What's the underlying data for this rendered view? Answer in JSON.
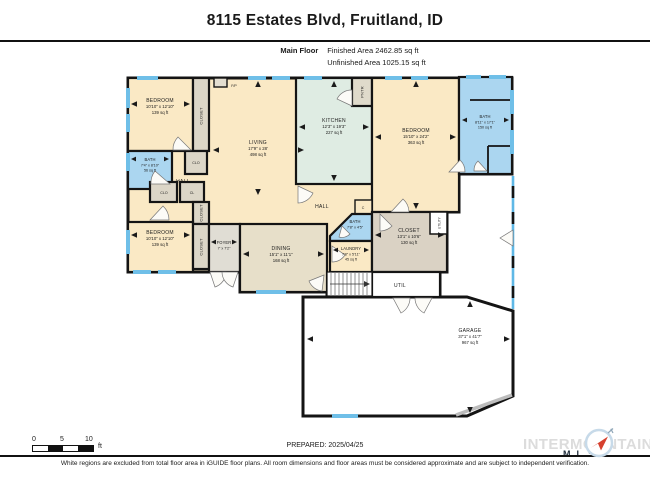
{
  "header": {
    "title": "8115 Estates Blvd, Fruitland, ID",
    "floor_label": "Main Floor",
    "finished_area": "Finished Area 2462.85 sq ft",
    "unfinished_area": "Unfinished Area 1025.15 sq ft"
  },
  "rooms": [
    {
      "name": "BEDROOM",
      "dims": "10'10\" x 12'10\"",
      "area": "139 sq ft"
    },
    {
      "name": "LIVING",
      "dims": "17'9\" x 28'",
      "area": "498 sq ft"
    },
    {
      "name": "KITCHEN",
      "dims": "12'3\" x 19'3\"",
      "area": "227 sq ft"
    },
    {
      "name": "BEDROOM",
      "dims": "15'10\" x 24'2\"",
      "area": "363 sq ft"
    },
    {
      "name": "BATH",
      "dims": "8'11\" x 17'1\"",
      "area": "150 sq ft"
    },
    {
      "name": "BATH",
      "dims": "7'4\" x 8'10\"",
      "area": "56 sq ft"
    },
    {
      "name": "BEDROOM",
      "dims": "10'10\" x 12'10\"",
      "area": "139 sq ft"
    },
    {
      "name": "FOYER",
      "dims": "7' x 7'2\""
    },
    {
      "name": "DINING",
      "dims": "15'1\" x 11'1\"",
      "area": "168 sq ft"
    },
    {
      "name": "BATH",
      "dims": "7'8\" x 4'5\""
    },
    {
      "name": "LAUNDRY",
      "dims": "7'8\" x 5'11\"",
      "area": "45 sq ft"
    },
    {
      "name": "CLOSET",
      "dims": "13'1\" x 10'6\"",
      "area": "130 sq ft"
    },
    {
      "name": "GARAGE",
      "dims": "37'1\" x 41'7\"",
      "area": "967 sq ft"
    }
  ],
  "labels": {
    "hall": "HALL",
    "closet": "CLOSET",
    "clo": "CLO",
    "cl": "CL",
    "c": "C",
    "fp": "F/P",
    "pntr": "PNTR",
    "util": "UTIL",
    "utility": "UTILITY"
  },
  "footer": {
    "scale_0": "0",
    "scale_5": "5",
    "scale_10": "10",
    "scale_unit": "ft",
    "prepared": "PREPARED: 2025/04/25",
    "logo_text": "INTERMOUNTAIN",
    "logo_sub": "MLS",
    "disclaimer": "White regions are excluded from total floor area in iGUIDE floor plans. All room dimensions and floor areas must be considered approximate and are subject to independent verification."
  },
  "colors": {
    "wall": "#141414",
    "finished_cream": "#FAE9C5",
    "bath_blue": "#ABD6F0",
    "kitchen_mint": "#DFECE3",
    "closet_gray": "#DCD6C7",
    "dining_tan": "#E7DFC9",
    "foyer_gray": "#E0DDD4",
    "window_blue": "#6FBFE8",
    "logo_gray": "#DCDCDC",
    "compass_red": "#D6402E"
  }
}
